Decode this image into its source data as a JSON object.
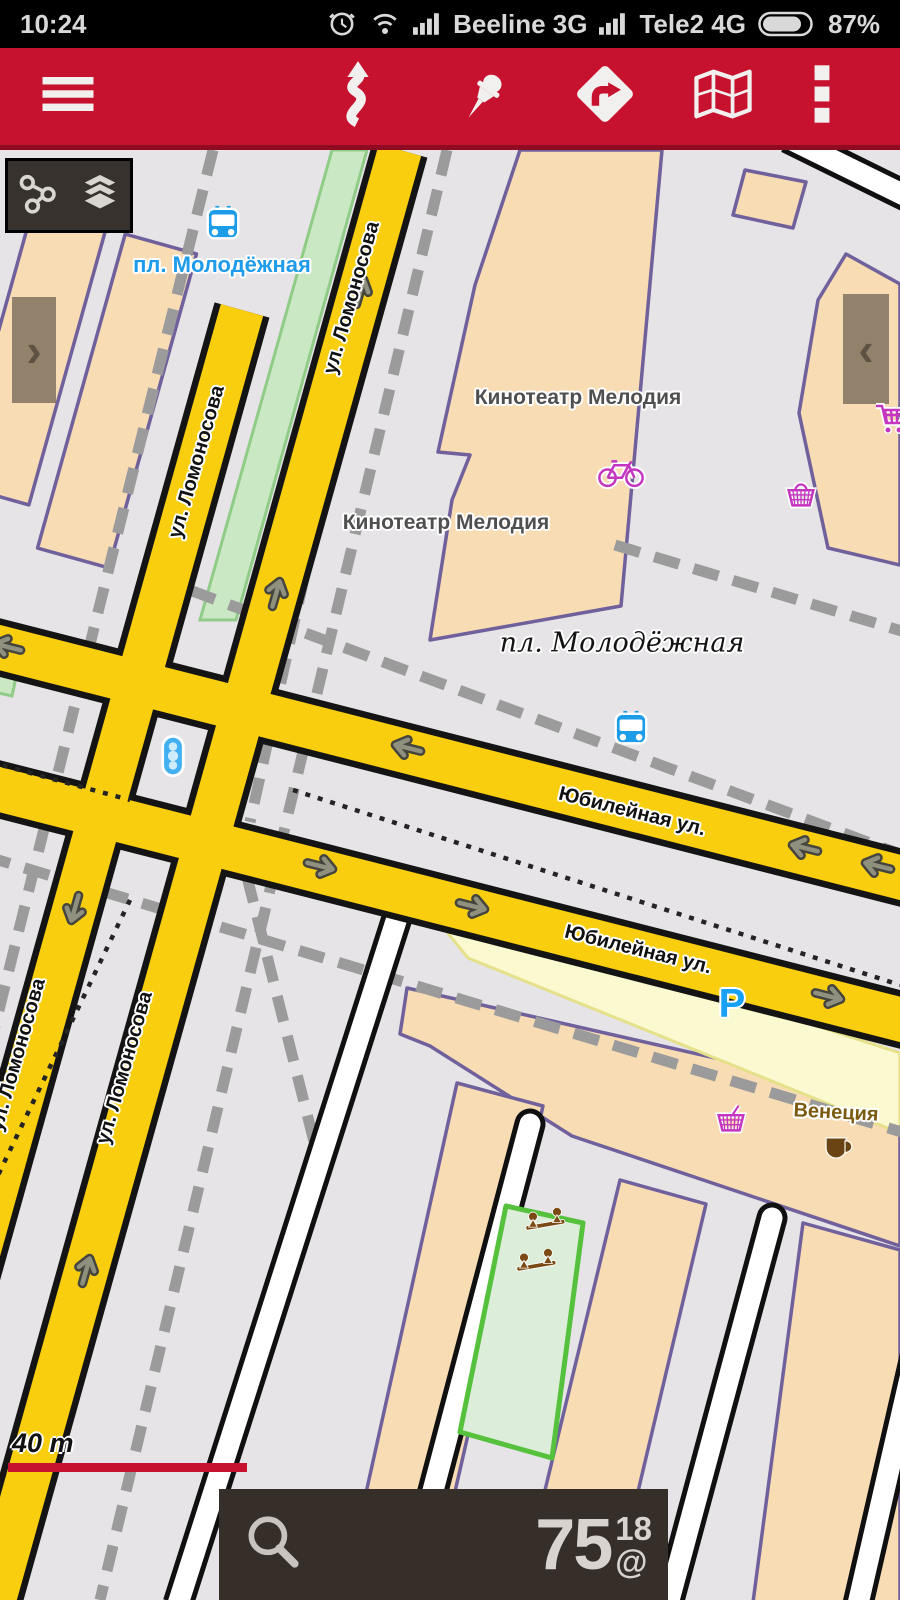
{
  "status_bar": {
    "time": "10:24",
    "carrier_1": "Beeline 3G",
    "carrier_2": "Tele2 4G",
    "battery": "87%"
  },
  "map": {
    "place_labels": {
      "bus_stop_square": "пл. Молодёжная",
      "square_name": "пл. Молодёжная",
      "cinema": "Кинотеатр Мелодия",
      "cafe": "Венеция",
      "parking": "P"
    },
    "street_labels": {
      "lomonosova": "ул. Ломоносова",
      "yubileynaya": "Юбилейная ул."
    },
    "scale_text": "40 m",
    "zoom_widget": {
      "main": "75",
      "sup": "18",
      "sub": "@"
    }
  },
  "colors": {
    "toolbar_red": "#C6112F",
    "road_yellow": "#F8CE0F",
    "building_fill": "#F8DCB4",
    "transit_blue": "#1D9CE8",
    "poi_magenta": "#C435C0"
  }
}
